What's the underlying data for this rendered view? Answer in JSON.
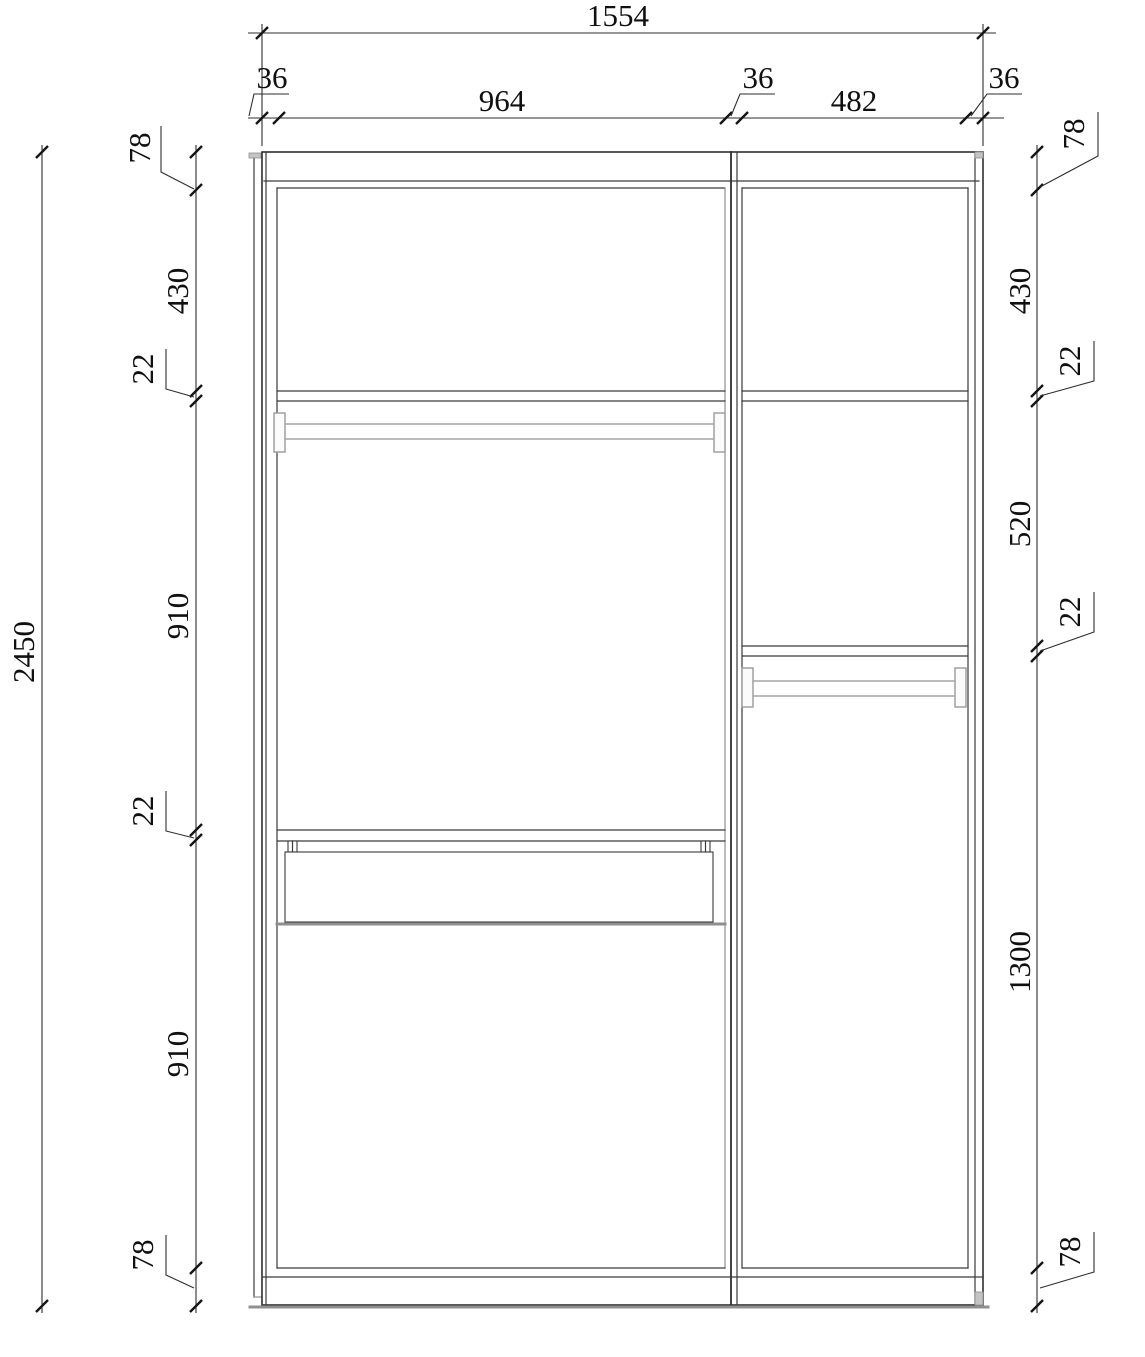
{
  "drawing": {
    "kind": "wardrobe-internal-elevation",
    "description": "CAD elevation of a two-bay wardrobe carcass with shelves, two hanging rods and one drawer",
    "units": "mm"
  },
  "dims": {
    "top_overall": "1554",
    "top_chain": [
      "36",
      "964",
      "36",
      "482",
      "36"
    ],
    "left_overall": "2450",
    "left_chain": [
      "78",
      "430",
      "22",
      "910",
      "22",
      "910",
      "78"
    ],
    "right_chain": [
      "78",
      "430",
      "22",
      "520",
      "22",
      "1300",
      "78"
    ]
  },
  "colors": {
    "line": "#2e2e2e",
    "soft_line": "#8f8f8f",
    "rod": "#a6a6a6",
    "cap_fill": "#c4c4c4",
    "text": "#101010",
    "background": "#ffffff"
  }
}
